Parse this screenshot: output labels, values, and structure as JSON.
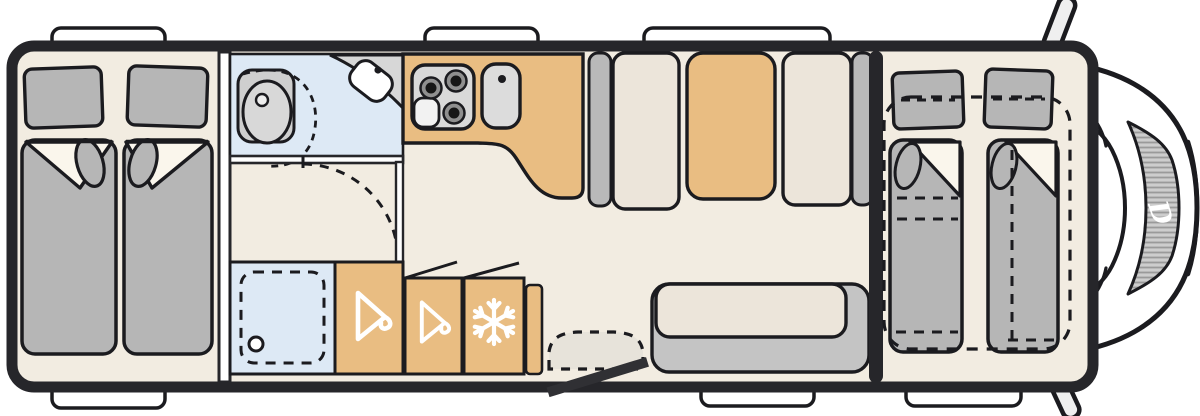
{
  "diagram": {
    "kind": "motorhome-floorplan-top-view",
    "logo": {
      "text": "D"
    },
    "colors": {
      "wall": "#26262a",
      "outline": "#1b1b1f",
      "floor": "#f2ece1",
      "cabinet_orange": "#e9bd82",
      "cabinet_beige": "#ece5da",
      "furniture_gray": "#b6b6b6",
      "partition_gray": "#b9b9b9",
      "bench_back_gray": "#c4c4c4",
      "wet_room_blue": "#dde9f5",
      "counter_gray": "#d7d7d7",
      "stove_gray": "#d9d9d9",
      "step_gray": "#e7e3da",
      "white": "#ffffff"
    },
    "areas": {
      "rear_bedroom": "twin single beds with pillows",
      "washroom": "swivel toilet, corner washbasin",
      "shower": "shower cubicle with drain",
      "wardrobe_1": "wardrobe with hanger",
      "wardrobe_2": "wardrobe with hanger",
      "fridge": "refrigerator",
      "kitchen": "three-burner hob and sink",
      "tall_cabinets": "storage columns",
      "bench_seat": "side bench seat",
      "front_beds": "drop-down double bed (dashed)",
      "entry": "entrance door with step",
      "cab": "driver cab, windscreen, mirrors"
    },
    "icons": [
      "hanger-icon",
      "hanger-icon",
      "snowflake-icon",
      "burner-icon",
      "drain-icon",
      "faucet-icon",
      "brand-logo-d"
    ]
  }
}
